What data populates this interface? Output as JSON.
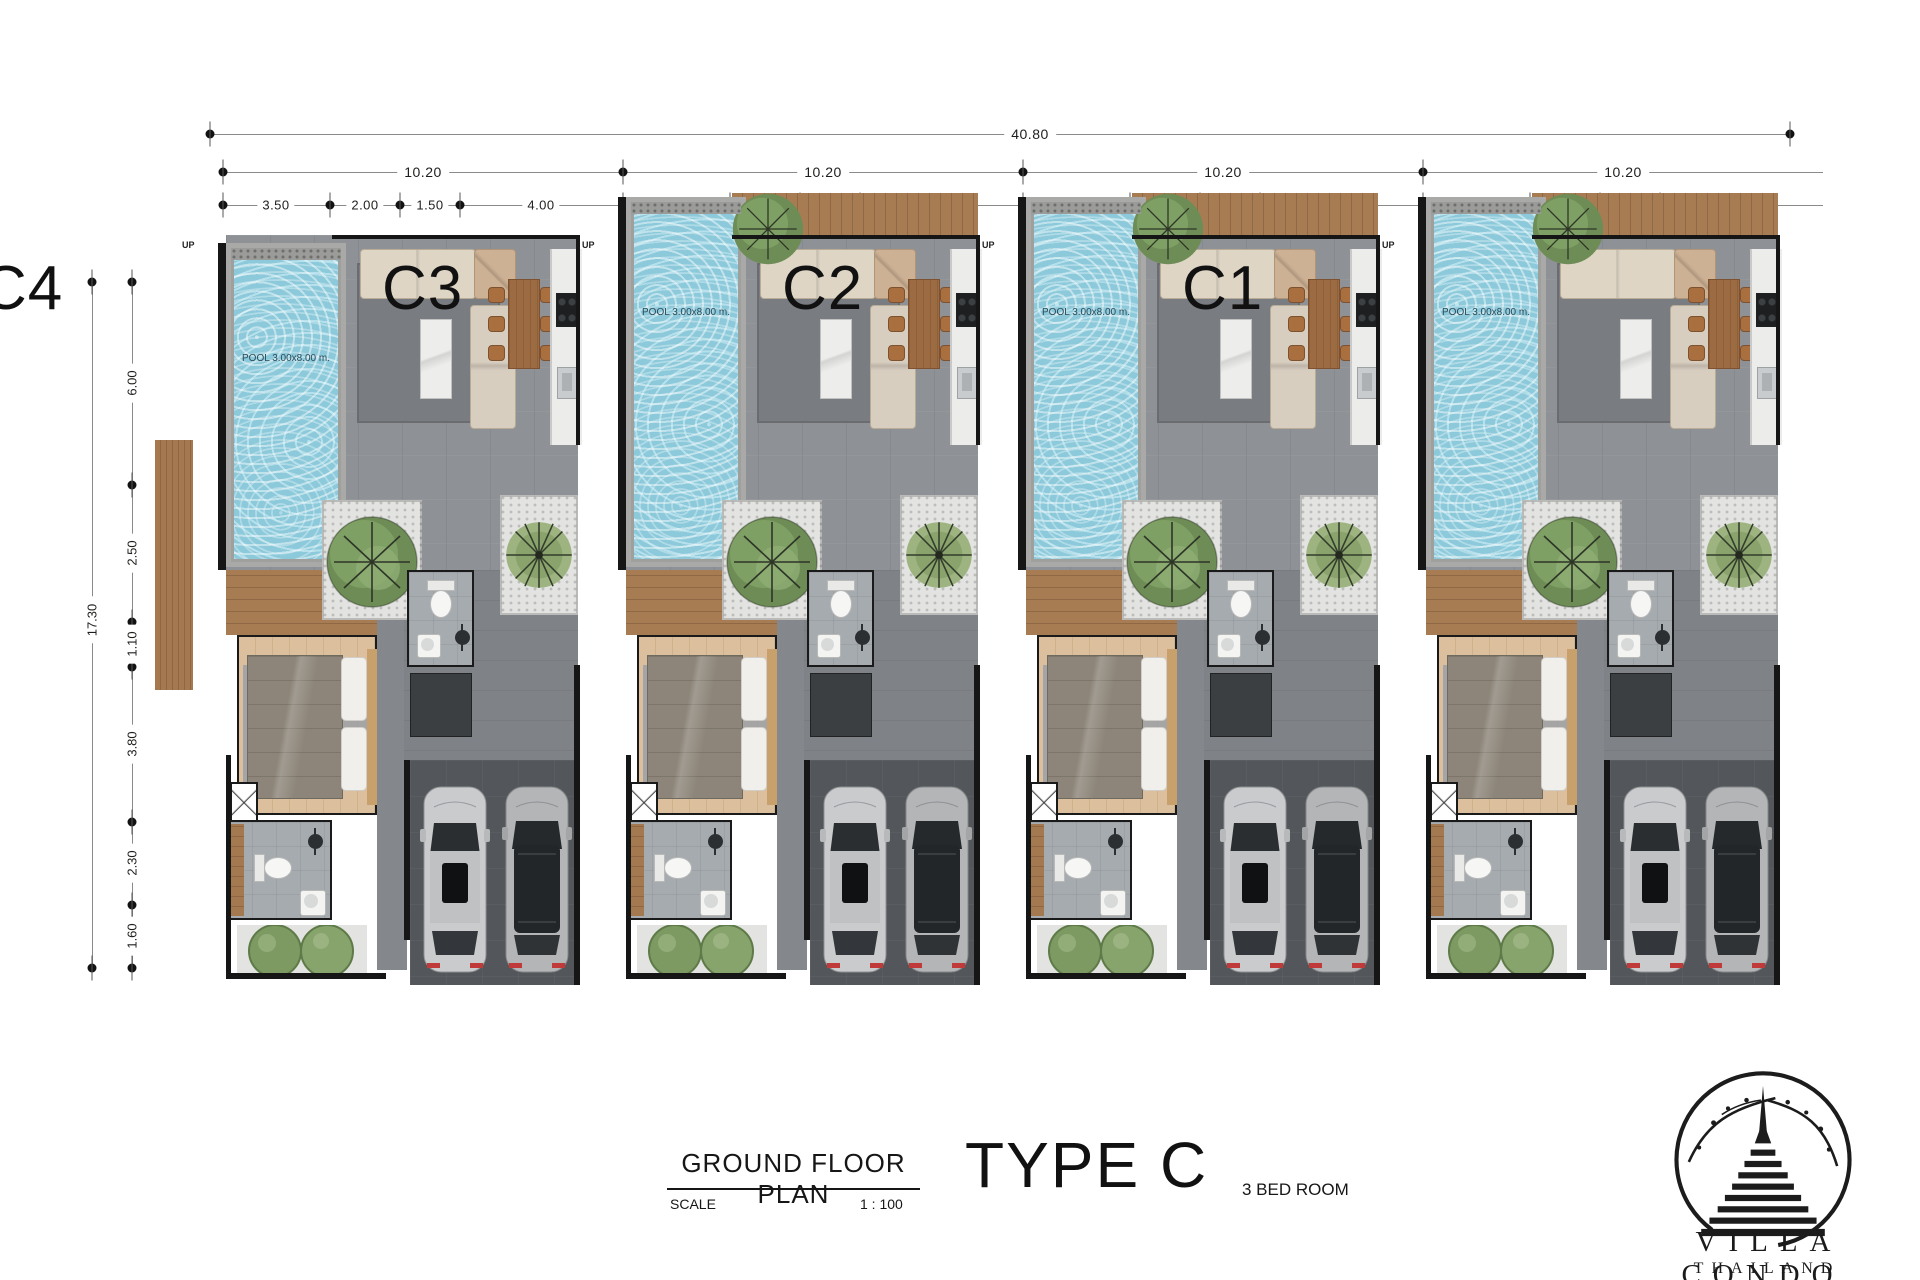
{
  "dims": {
    "overall_width": "40.80",
    "overall_height": "17.30",
    "left_segments": [
      "6.00",
      "2.50",
      "1.10",
      "3.80",
      "2.30",
      "1.60"
    ]
  },
  "units": [
    {
      "label": "C4",
      "pool_label": "POOL 3.00x8.00 m.",
      "up_label": "UP",
      "dim_width": "10.20",
      "dim_sub": [
        "3.50",
        "2.00",
        "1.50",
        "4.00"
      ],
      "has_top_deck": false,
      "has_side_deck": true
    },
    {
      "label": "C3",
      "pool_label": "POOL 3.00x8.00 m.",
      "up_label": "UP",
      "dim_width": "10.20",
      "dim_sub": [
        "3.50",
        "2.00",
        "1.50",
        "4.00"
      ],
      "has_top_deck": true,
      "has_side_deck": false
    },
    {
      "label": "C2",
      "pool_label": "POOL 3.00x8.00 m.",
      "up_label": "UP",
      "dim_width": "10.20",
      "dim_sub": [
        "3.50",
        "2.00",
        "1.50",
        "4.00"
      ],
      "has_top_deck": true,
      "has_side_deck": false
    },
    {
      "label": "C1",
      "pool_label": "POOL 3.00x8.00 m.",
      "up_label": "UP",
      "dim_width": "10.20",
      "dim_sub": [
        "3.50",
        "2.00",
        "1.50",
        "4.00"
      ],
      "has_top_deck": true,
      "has_side_deck": false
    }
  ],
  "title_block": {
    "title": "GROUND FLOOR PLAN",
    "scale_label": "SCALE",
    "scale_value": "1 : 100",
    "type_label": "TYPE C",
    "bedrooms": "3 BED ROOM"
  },
  "logo": {
    "name": "VILLA CONDO",
    "country": "THAILAND"
  },
  "colors": {
    "pool_water": "#8ccadb",
    "deck_wood": "#a87c52",
    "floor_gray": "#8e9195",
    "garage_floor": "#53565a",
    "wall": "#161616",
    "tree_green": "#6e8c55",
    "car_silver": "#c9cbcc",
    "bedroom_wood": "#d8bc9a"
  }
}
